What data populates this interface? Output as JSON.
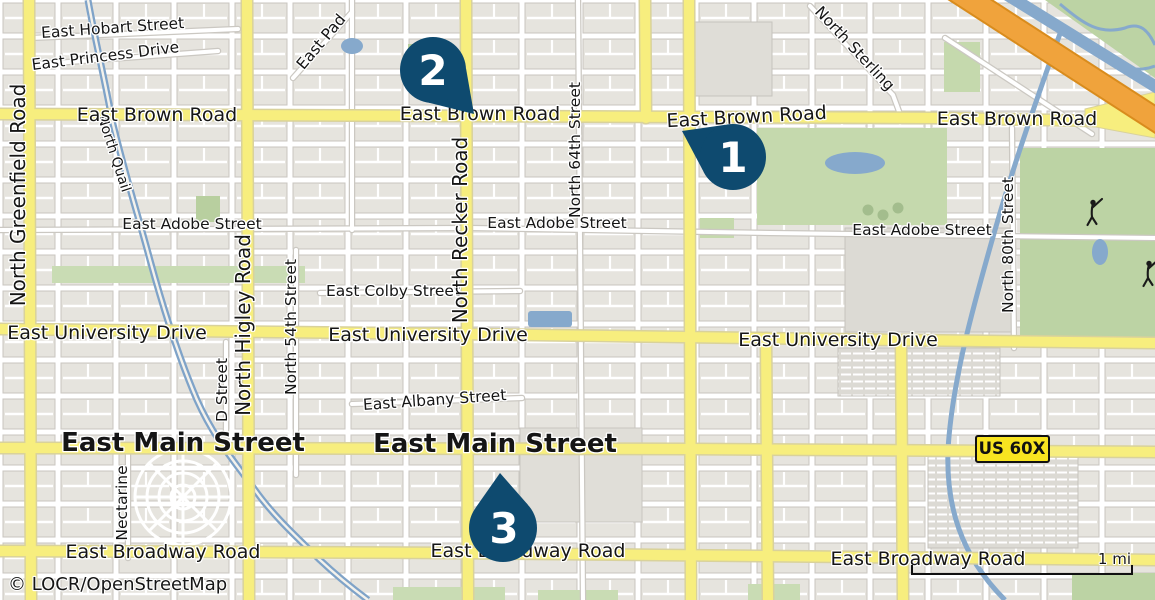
{
  "map": {
    "attribution": "© LOCR/OpenStreetMap",
    "scale": {
      "label": "1 mi"
    },
    "shield": {
      "label": "US 60X"
    },
    "markers": [
      {
        "label": "1"
      },
      {
        "label": "2"
      },
      {
        "label": "3"
      }
    ],
    "roads": {
      "brown": "East Brown Road",
      "university": "East University Drive",
      "main": "East Main Street",
      "broadway": "East Broadway Road",
      "greenfield": "North Greenfield Road",
      "higley": "North Higley Road",
      "recker": "North Recker Road"
    },
    "streets": {
      "hobart": "East Hobart Street",
      "princess": "East Princess Drive",
      "pad": "East Pad",
      "sterling": "North Sterling",
      "quail": "North Quail",
      "adobe": "East Adobe Street",
      "colby": "East Colby Street",
      "albany": "East Albany Street",
      "n64": "North 64th Street",
      "n54": "North 54th Street",
      "n80": "North 80th Street",
      "dstreet": "D Street",
      "nectarine": "Nectarine"
    },
    "colors": {
      "marker": "#0e4a6f",
      "road_major": "#f7ee7e",
      "highway": "#f0a33c",
      "water": "#86a9cc",
      "park": "#c5d9ad",
      "shield_bg": "#f8e420"
    }
  }
}
